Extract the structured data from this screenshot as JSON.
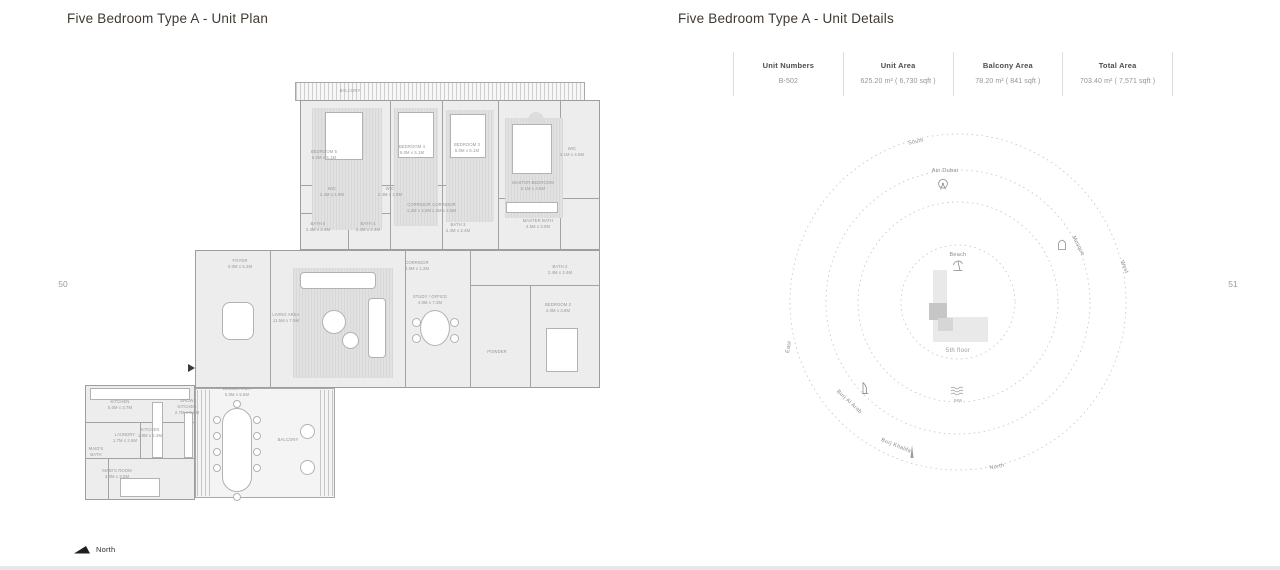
{
  "page": {
    "left_title": "Five Bedroom Type A - Unit Plan",
    "right_title": "Five Bedroom Type A - Unit Details",
    "left_page_number": "50",
    "right_page_number": "51",
    "north_label": "North"
  },
  "details_table": {
    "columns": [
      {
        "header": "Unit Numbers",
        "value": "B-502"
      },
      {
        "header": "Unit Area",
        "value": "625.20 m² ( 6,730 sqft )"
      },
      {
        "header": "Balcony Area",
        "value": "78.20 m² ( 841 sqft )"
      },
      {
        "header": "Total Area",
        "value": "703.40 m² ( 7,571 sqft )"
      }
    ]
  },
  "compass": {
    "rings": [
      57,
      100,
      132,
      168
    ],
    "labels": [
      {
        "text": "South",
        "x": 916,
        "y": 142,
        "rot": -12
      },
      {
        "text": "Ain Dubai",
        "x": 945,
        "y": 171,
        "rot": 0
      },
      {
        "text": "Mosque",
        "x": 1078,
        "y": 246,
        "rot": 62
      },
      {
        "text": "West",
        "x": 1124,
        "y": 267,
        "rot": 68
      },
      {
        "text": "East",
        "x": 789,
        "y": 347,
        "rot": -80
      },
      {
        "text": "Burj Al Arab",
        "x": 849,
        "y": 402,
        "rot": 43
      },
      {
        "text": "Burj Khalifa",
        "x": 896,
        "y": 446,
        "rot": 22
      },
      {
        "text": "sea",
        "x": 958,
        "y": 400,
        "rot": 0,
        "cls": "small"
      },
      {
        "text": "North",
        "x": 997,
        "y": 467,
        "rot": -10
      },
      {
        "text": "Beach",
        "x": 958,
        "y": 255,
        "rot": 0
      },
      {
        "text": "5th floor",
        "x": 958,
        "y": 351,
        "rot": 0,
        "cls": "floor"
      }
    ],
    "icons": [
      {
        "name": "ferris-wheel-icon",
        "x": 943,
        "y": 185
      },
      {
        "name": "mosque-icon",
        "x": 1062,
        "y": 245
      },
      {
        "name": "burj-al-arab-icon",
        "x": 865,
        "y": 388
      },
      {
        "name": "burj-khalifa-icon",
        "x": 912,
        "y": 452
      },
      {
        "name": "sea-waves-icon",
        "x": 958,
        "y": 391
      },
      {
        "name": "beach-umbrella-icon",
        "x": 958,
        "y": 266
      }
    ],
    "building": [
      {
        "name": "building-wing-vertical",
        "x": 933,
        "y": 270,
        "w": 14,
        "h": 72,
        "color": "#e9e9e9"
      },
      {
        "name": "building-wing-horizontal",
        "x": 933,
        "y": 317,
        "w": 55,
        "h": 25,
        "color": "#e9e9e9"
      },
      {
        "name": "unit-highlight",
        "x": 929,
        "y": 303,
        "w": 18,
        "h": 17,
        "color": "#c6c6c6"
      },
      {
        "name": "unit-highlight-step",
        "x": 938,
        "y": 318,
        "w": 15,
        "h": 13,
        "color": "#d6d6d6"
      }
    ]
  },
  "floorplan": {
    "shapes": [
      {
        "t": "hatchblock",
        "x": 295,
        "y": 82,
        "w": 290,
        "h": 19
      },
      {
        "t": "block",
        "x": 300,
        "y": 100,
        "w": 300,
        "h": 150
      },
      {
        "t": "block",
        "x": 195,
        "y": 250,
        "w": 405,
        "h": 138
      },
      {
        "t": "block",
        "x": 85,
        "y": 385,
        "w": 110,
        "h": 115
      },
      {
        "t": "blocklight",
        "x": 195,
        "y": 388,
        "w": 140,
        "h": 110
      },
      {
        "t": "hatch",
        "x": 197,
        "y": 390,
        "w": 15,
        "h": 106
      },
      {
        "t": "hatch",
        "x": 320,
        "y": 390,
        "w": 14,
        "h": 106
      },
      {
        "t": "vline",
        "x": 390,
        "y": 100,
        "h": 150
      },
      {
        "t": "vline",
        "x": 442,
        "y": 100,
        "h": 150
      },
      {
        "t": "vline",
        "x": 498,
        "y": 100,
        "h": 150
      },
      {
        "t": "vline",
        "x": 560,
        "y": 100,
        "h": 150
      },
      {
        "t": "hline",
        "x": 300,
        "y": 185,
        "w": 160
      },
      {
        "t": "hline",
        "x": 300,
        "y": 213,
        "w": 90
      },
      {
        "t": "vline",
        "x": 348,
        "y": 185,
        "h": 65
      },
      {
        "t": "hline",
        "x": 498,
        "y": 198,
        "w": 102
      },
      {
        "t": "vline",
        "x": 270,
        "y": 250,
        "h": 138
      },
      {
        "t": "vline",
        "x": 405,
        "y": 250,
        "h": 138
      },
      {
        "t": "vline",
        "x": 470,
        "y": 250,
        "h": 138
      },
      {
        "t": "vline",
        "x": 530,
        "y": 285,
        "h": 103
      },
      {
        "t": "hline",
        "x": 470,
        "y": 285,
        "w": 130
      },
      {
        "t": "hline",
        "x": 85,
        "y": 422,
        "w": 110
      },
      {
        "t": "hline",
        "x": 85,
        "y": 458,
        "w": 110
      },
      {
        "t": "vline",
        "x": 140,
        "y": 422,
        "h": 36
      },
      {
        "t": "vline",
        "x": 108,
        "y": 458,
        "h": 42
      },
      {
        "t": "carpet",
        "x": 312,
        "y": 108,
        "w": 70,
        "h": 122
      },
      {
        "t": "carpet",
        "x": 394,
        "y": 108,
        "w": 44,
        "h": 118
      },
      {
        "t": "carpet",
        "x": 446,
        "y": 110,
        "w": 48,
        "h": 112
      },
      {
        "t": "carpet",
        "x": 505,
        "y": 118,
        "w": 58,
        "h": 100
      },
      {
        "t": "carpet",
        "x": 293,
        "y": 268,
        "w": 100,
        "h": 110
      },
      {
        "t": "ccirc",
        "x": 528,
        "y": 112,
        "w": 16,
        "h": 16
      },
      {
        "t": "furn",
        "x": 325,
        "y": 112,
        "w": 38,
        "h": 48
      },
      {
        "t": "furn",
        "x": 398,
        "y": 112,
        "w": 36,
        "h": 46
      },
      {
        "t": "furn",
        "x": 450,
        "y": 114,
        "w": 36,
        "h": 44
      },
      {
        "t": "furn",
        "x": 512,
        "y": 124,
        "w": 40,
        "h": 50
      },
      {
        "t": "furn",
        "x": 546,
        "y": 328,
        "w": 32,
        "h": 44
      },
      {
        "t": "furn",
        "x": 120,
        "y": 478,
        "w": 40,
        "h": 19
      },
      {
        "t": "furn",
        "x": 300,
        "y": 272,
        "w": 76,
        "h": 17,
        "r": 4
      },
      {
        "t": "furn",
        "x": 368,
        "y": 298,
        "w": 18,
        "h": 60,
        "r": 4
      },
      {
        "t": "circle",
        "x": 322,
        "y": 310,
        "w": 24,
        "h": 24
      },
      {
        "t": "circle",
        "x": 342,
        "y": 332,
        "w": 17,
        "h": 17
      },
      {
        "t": "circle",
        "x": 420,
        "y": 310,
        "w": 30,
        "h": 36
      },
      {
        "t": "circle",
        "x": 412,
        "y": 318,
        "w": 9,
        "h": 9
      },
      {
        "t": "circle",
        "x": 412,
        "y": 334,
        "w": 9,
        "h": 9
      },
      {
        "t": "circle",
        "x": 450,
        "y": 318,
        "w": 9,
        "h": 9
      },
      {
        "t": "circle",
        "x": 450,
        "y": 334,
        "w": 9,
        "h": 9
      },
      {
        "t": "furn",
        "x": 222,
        "y": 408,
        "w": 30,
        "h": 84,
        "r": 15
      },
      {
        "t": "circle",
        "x": 213,
        "y": 416,
        "w": 8,
        "h": 8
      },
      {
        "t": "circle",
        "x": 213,
        "y": 432,
        "w": 8,
        "h": 8
      },
      {
        "t": "circle",
        "x": 213,
        "y": 448,
        "w": 8,
        "h": 8
      },
      {
        "t": "circle",
        "x": 213,
        "y": 464,
        "w": 8,
        "h": 8
      },
      {
        "t": "circle",
        "x": 253,
        "y": 416,
        "w": 8,
        "h": 8
      },
      {
        "t": "circle",
        "x": 253,
        "y": 432,
        "w": 8,
        "h": 8
      },
      {
        "t": "circle",
        "x": 253,
        "y": 448,
        "w": 8,
        "h": 8
      },
      {
        "t": "circle",
        "x": 253,
        "y": 464,
        "w": 8,
        "h": 8
      },
      {
        "t": "circle",
        "x": 233,
        "y": 400,
        "w": 8,
        "h": 8
      },
      {
        "t": "circle",
        "x": 233,
        "y": 493,
        "w": 8,
        "h": 8
      },
      {
        "t": "furn",
        "x": 90,
        "y": 388,
        "w": 100,
        "h": 12
      },
      {
        "t": "furn",
        "x": 152,
        "y": 402,
        "w": 11,
        "h": 56
      },
      {
        "t": "furn",
        "x": 184,
        "y": 412,
        "w": 9,
        "h": 46
      },
      {
        "t": "furn",
        "x": 506,
        "y": 202,
        "w": 52,
        "h": 11
      },
      {
        "t": "furn",
        "x": 222,
        "y": 302,
        "w": 32,
        "h": 38,
        "r": 8
      },
      {
        "t": "circle",
        "x": 300,
        "y": 424,
        "w": 15,
        "h": 15
      },
      {
        "t": "circle",
        "x": 300,
        "y": 460,
        "w": 15,
        "h": 15
      },
      {
        "t": "tri",
        "x": 188,
        "y": 364
      }
    ],
    "labels": [
      {
        "x": 350,
        "y": 91,
        "t": "BALCONY"
      },
      {
        "x": 324,
        "y": 155,
        "t": "BEDROOM 5\n5.0M x 5.1M"
      },
      {
        "x": 412,
        "y": 150,
        "t": "BEDROOM 4\n5.0M x 5.1M"
      },
      {
        "x": 467,
        "y": 148,
        "t": "BEDROOM 3\n5.0M x 5.1M"
      },
      {
        "x": 533,
        "y": 186,
        "t": "MASTER BEDROOM\n5.1M x 4.5M"
      },
      {
        "x": 572,
        "y": 152,
        "t": "WIC\n3.1M x 4.5M"
      },
      {
        "x": 332,
        "y": 192,
        "t": "WIC\n2.4M x 1.9M"
      },
      {
        "x": 390,
        "y": 192,
        "t": "WIC\n2.4M x 1.9M"
      },
      {
        "x": 318,
        "y": 227,
        "t": "BATH 5\n2.4M x 2.4M"
      },
      {
        "x": 368,
        "y": 227,
        "t": "BATH 4\n2.4M x 2.4M"
      },
      {
        "x": 419,
        "y": 208,
        "t": "CORRIDOR\n1.2M x 2.6M"
      },
      {
        "x": 444,
        "y": 208,
        "t": "CORRIDOR\n1.2M x 2.6M"
      },
      {
        "x": 458,
        "y": 228,
        "t": "BATH 3\n2.4M x 2.4M"
      },
      {
        "x": 538,
        "y": 224,
        "t": "MASTER BATH\n4.5M x 3.0M"
      },
      {
        "x": 417,
        "y": 266,
        "t": "CORRIDOR\n4.5M x 1.2M"
      },
      {
        "x": 286,
        "y": 318,
        "t": "LIVING AREA\n11.5M x 7.5M"
      },
      {
        "x": 430,
        "y": 300,
        "t": "STUDY / OFFICE\n4.0M x 7.3M"
      },
      {
        "x": 240,
        "y": 264,
        "t": "FOYER\n3.0M x 5.2M"
      },
      {
        "x": 558,
        "y": 308,
        "t": "BEDROOM 2\n4.0M x 3.6M"
      },
      {
        "x": 560,
        "y": 270,
        "t": "BATH 2\n2.4M x 2.4M"
      },
      {
        "x": 497,
        "y": 352,
        "t": "POWDER"
      },
      {
        "x": 120,
        "y": 405,
        "t": "KITCHEN\n5.0M x 3.7M"
      },
      {
        "x": 187,
        "y": 407,
        "t": "SHOW\nKITCHEN\n2.7M x 5.0M"
      },
      {
        "x": 237,
        "y": 392,
        "t": "DINING AREA\n5.5M x 5.5M"
      },
      {
        "x": 125,
        "y": 438,
        "t": "LAUNDRY\n1.7M x 2.6M"
      },
      {
        "x": 150,
        "y": 433,
        "t": "KITCHEN\n1.9M x 2.3M"
      },
      {
        "x": 96,
        "y": 452,
        "t": "MAID'S\nBATH"
      },
      {
        "x": 117,
        "y": 474,
        "t": "MAID'S ROOM\n3.0M x 3.0M"
      },
      {
        "x": 288,
        "y": 440,
        "t": "BALCONY"
      }
    ]
  }
}
